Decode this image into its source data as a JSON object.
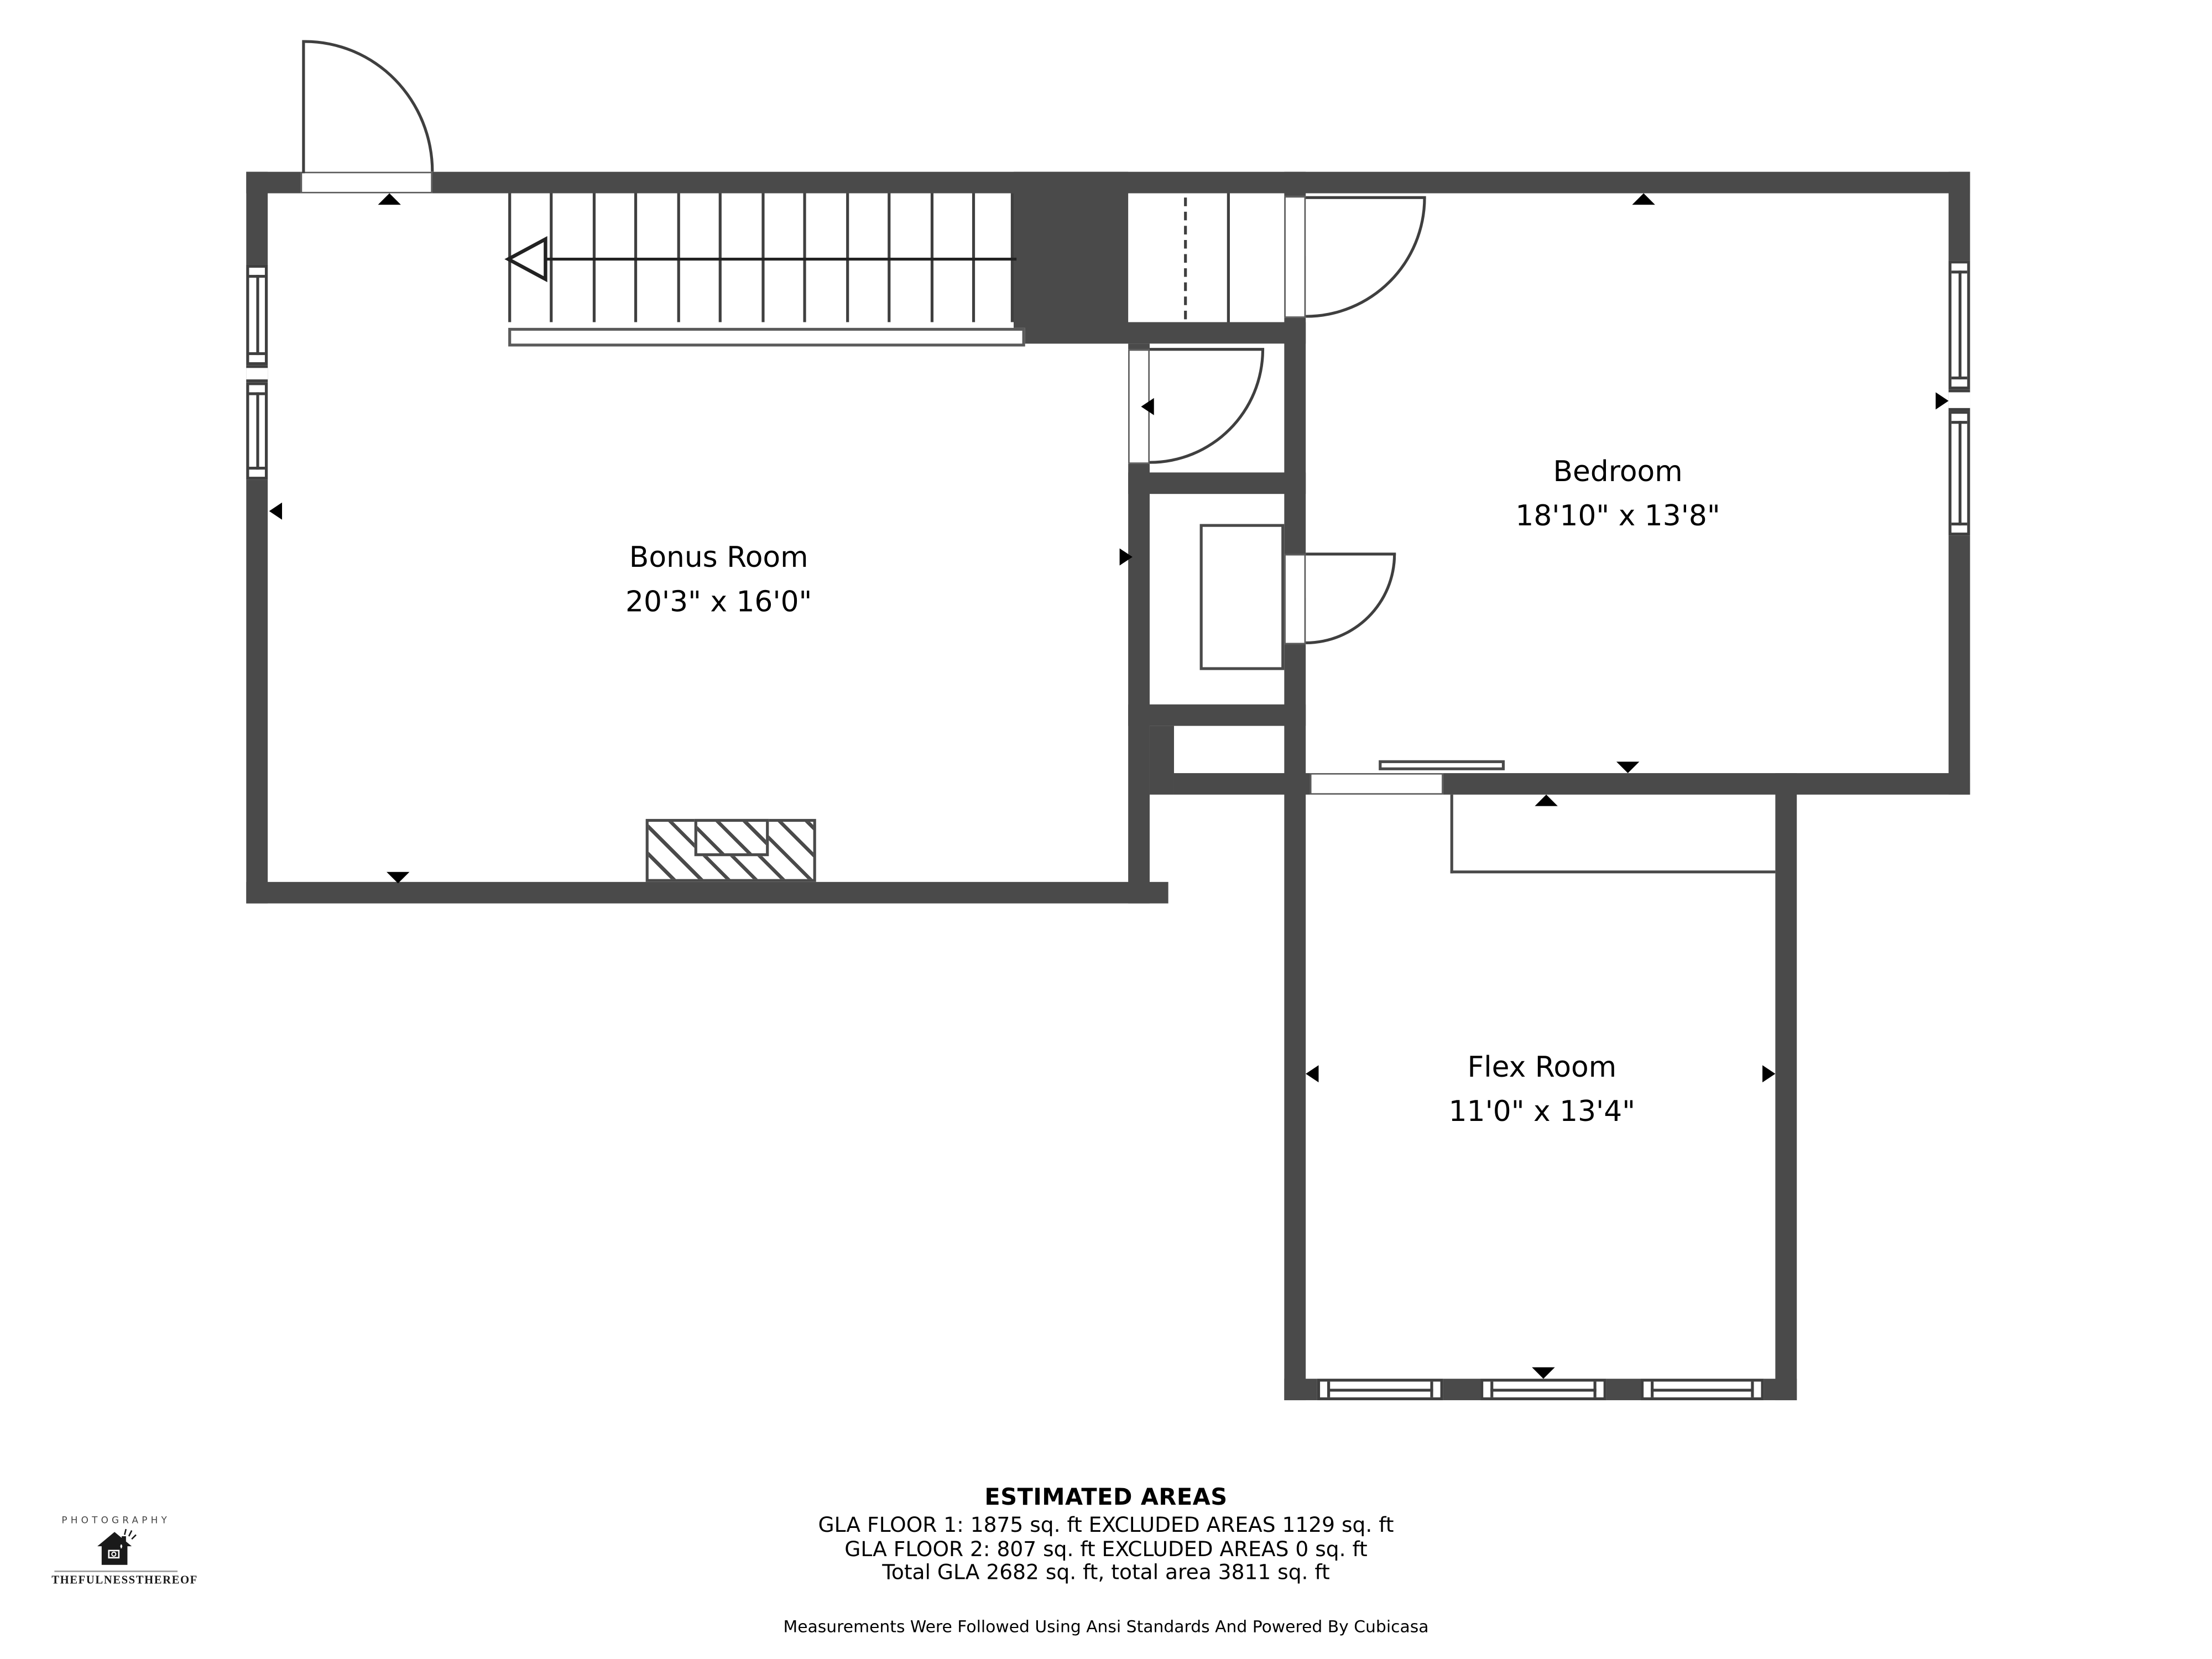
{
  "plan_title": "Floor 2 floor plan",
  "colors": {
    "wall": "#4a4a4a",
    "line": "#3f3f3f",
    "marker": "#000000",
    "text": "#000000",
    "background": "#ffffff"
  },
  "rooms": [
    {
      "id": "bonus-room",
      "label": "Bonus Room",
      "dimensions": "20'3\" x 16'0\""
    },
    {
      "id": "bedroom",
      "label": "Bedroom",
      "dimensions": "18'10\" x 13'8\""
    },
    {
      "id": "flex-room",
      "label": "Flex Room",
      "dimensions": "11'0\" x 13'4\""
    }
  ],
  "fixtures": [
    "staircase-with-down-arrow",
    "entry-door-arc",
    "bedroom-door-arc",
    "closet-door-arc",
    "hall-door-arc",
    "double-window-left-wall",
    "double-window-right-wall",
    "triple-window-flex-bottom-wall",
    "closet-wardrobe",
    "bedroom-shelf",
    "flex-closet-area",
    "hatched-chimney",
    "direction-markers"
  ],
  "estimated_areas": {
    "title": "ESTIMATED AREAS",
    "lines": [
      "GLA FLOOR 1: 1875 sq. ft EXCLUDED AREAS 1129 sq. ft",
      "GLA FLOOR 2: 807 sq. ft EXCLUDED AREAS 0 sq. ft",
      "Total GLA 2682 sq. ft, total area 3811 sq. ft"
    ],
    "footnote": "Measurements Were Followed Using Ansi Standards And Powered By Cubicasa"
  },
  "logo": {
    "top_text": "PHOTOGRAPHY",
    "bottom_text": "THEFULNESSTHEREOF",
    "icon": "house-camera-icon"
  }
}
